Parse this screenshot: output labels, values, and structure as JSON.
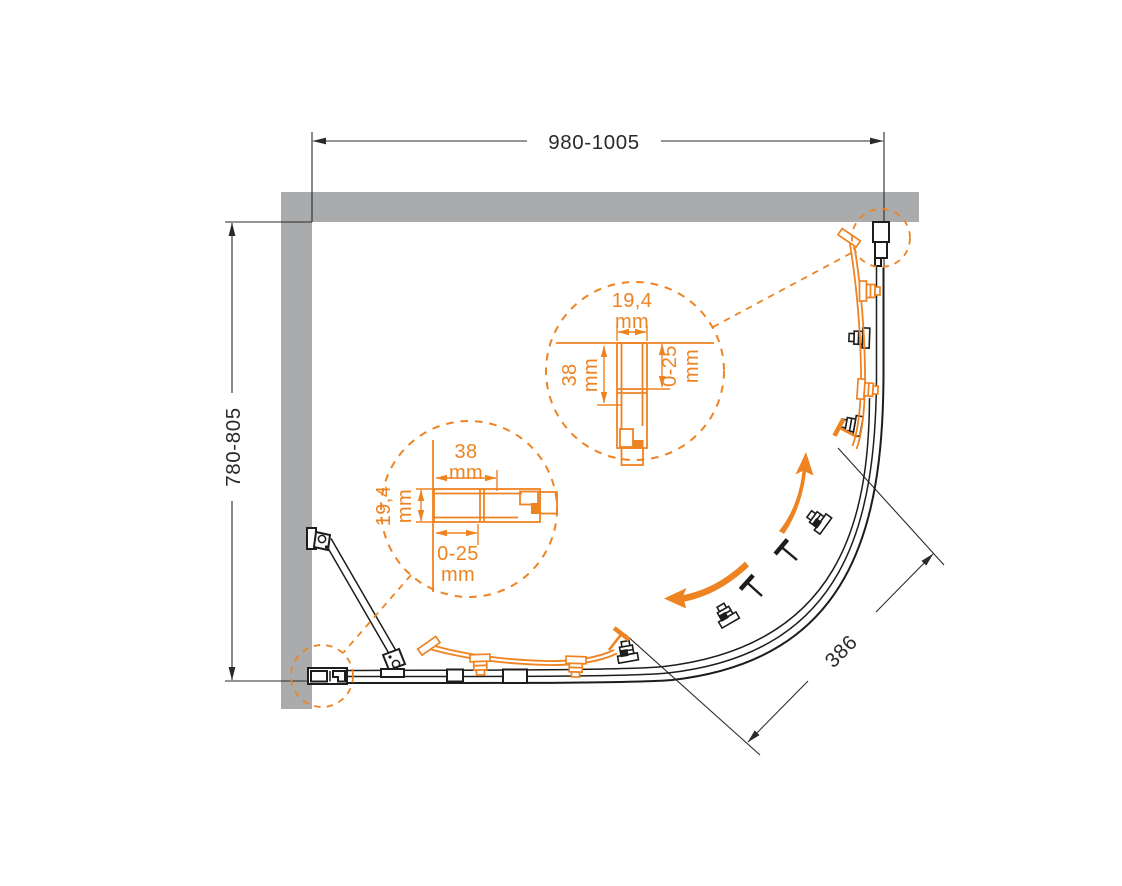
{
  "colors": {
    "background": "#ffffff",
    "wall_gray": "#a9abac",
    "line_black": "#1d1d1b",
    "accent_orange": "#ee8322",
    "dimension_text": "#2b2a29"
  },
  "dimensions": {
    "width": {
      "label": "980-1005"
    },
    "depth": {
      "label": "780-805"
    },
    "opening": {
      "label": "386"
    }
  },
  "details": {
    "unit": "mm",
    "vertical_profile": {
      "width": "19,4",
      "depth": "38",
      "adjustment": "0-25"
    },
    "horizontal_profile": {
      "width": "38",
      "depth": "19,4",
      "adjustment": "0-25"
    }
  }
}
